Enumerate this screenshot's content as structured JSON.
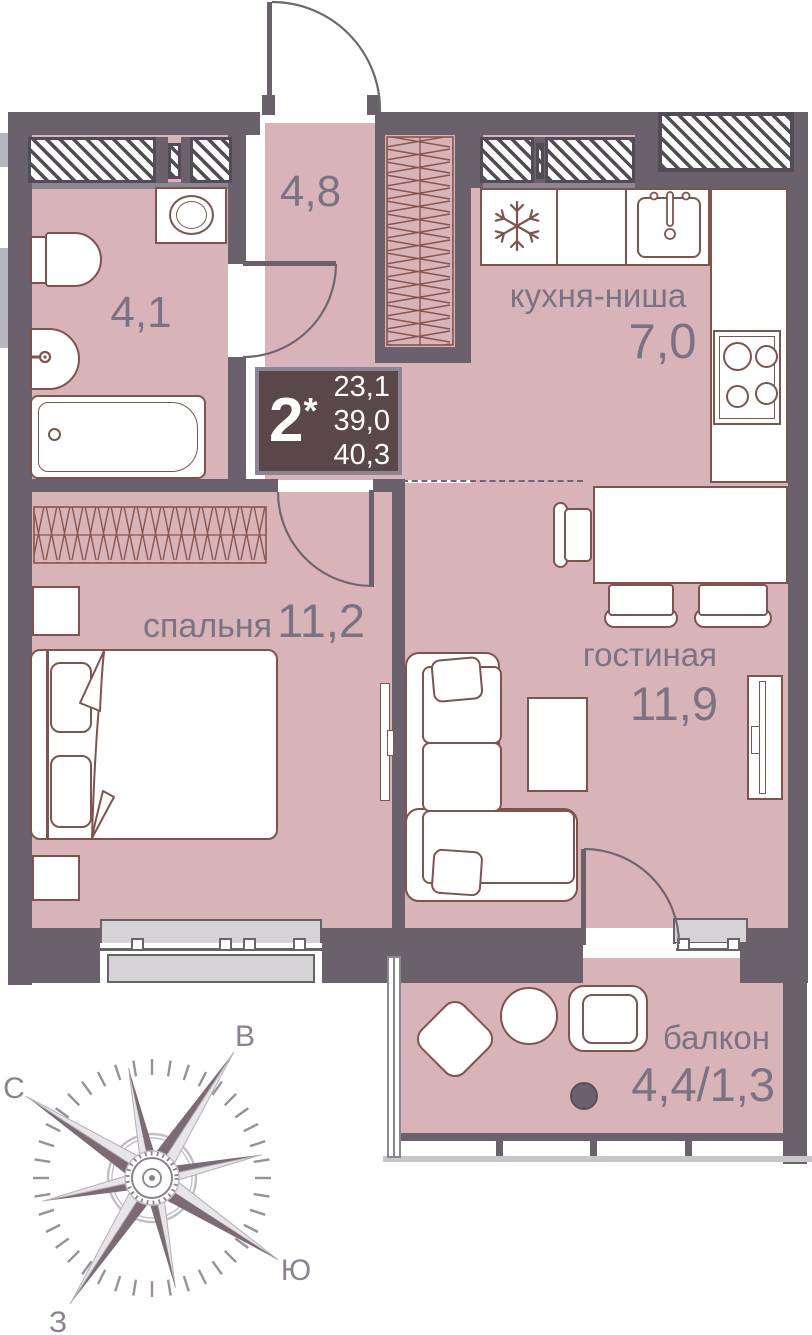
{
  "info_box": {
    "rooms_count": "2",
    "asterisk": "*",
    "areas": [
      "23,1",
      "39,0",
      "40,3"
    ]
  },
  "rooms": {
    "bathroom": {
      "area": "4,1"
    },
    "hallway": {
      "area": "4,8"
    },
    "kitchen": {
      "name": "кухня-ниша",
      "area": "7,0"
    },
    "bedroom": {
      "name": "спальня",
      "area": "11,2"
    },
    "living_room": {
      "name": "гостиная",
      "area": "11,9"
    },
    "balcony": {
      "name": "балкон",
      "area": "4,4/1,3"
    }
  },
  "compass": {
    "north": "С",
    "east": "В",
    "south": "Ю",
    "west": "З"
  },
  "colors": {
    "wall": "#6a616c",
    "room_fill": "#d8b4b9",
    "furniture_line": "#7f544d",
    "label_text": "#7b7383",
    "info_box_bg": "#5a4749",
    "info_box_text": "#ffffff",
    "sill_gray": "#d6d3d7",
    "hatch_line": "#514c57",
    "door_arc": "#6f6671",
    "compass_dark": "#7c6b74",
    "compass_light": "#e7e5e8",
    "compass_tick": "#9b8f99",
    "compass_letter": "#8d8191",
    "railing_light": "#c9c6cb"
  }
}
